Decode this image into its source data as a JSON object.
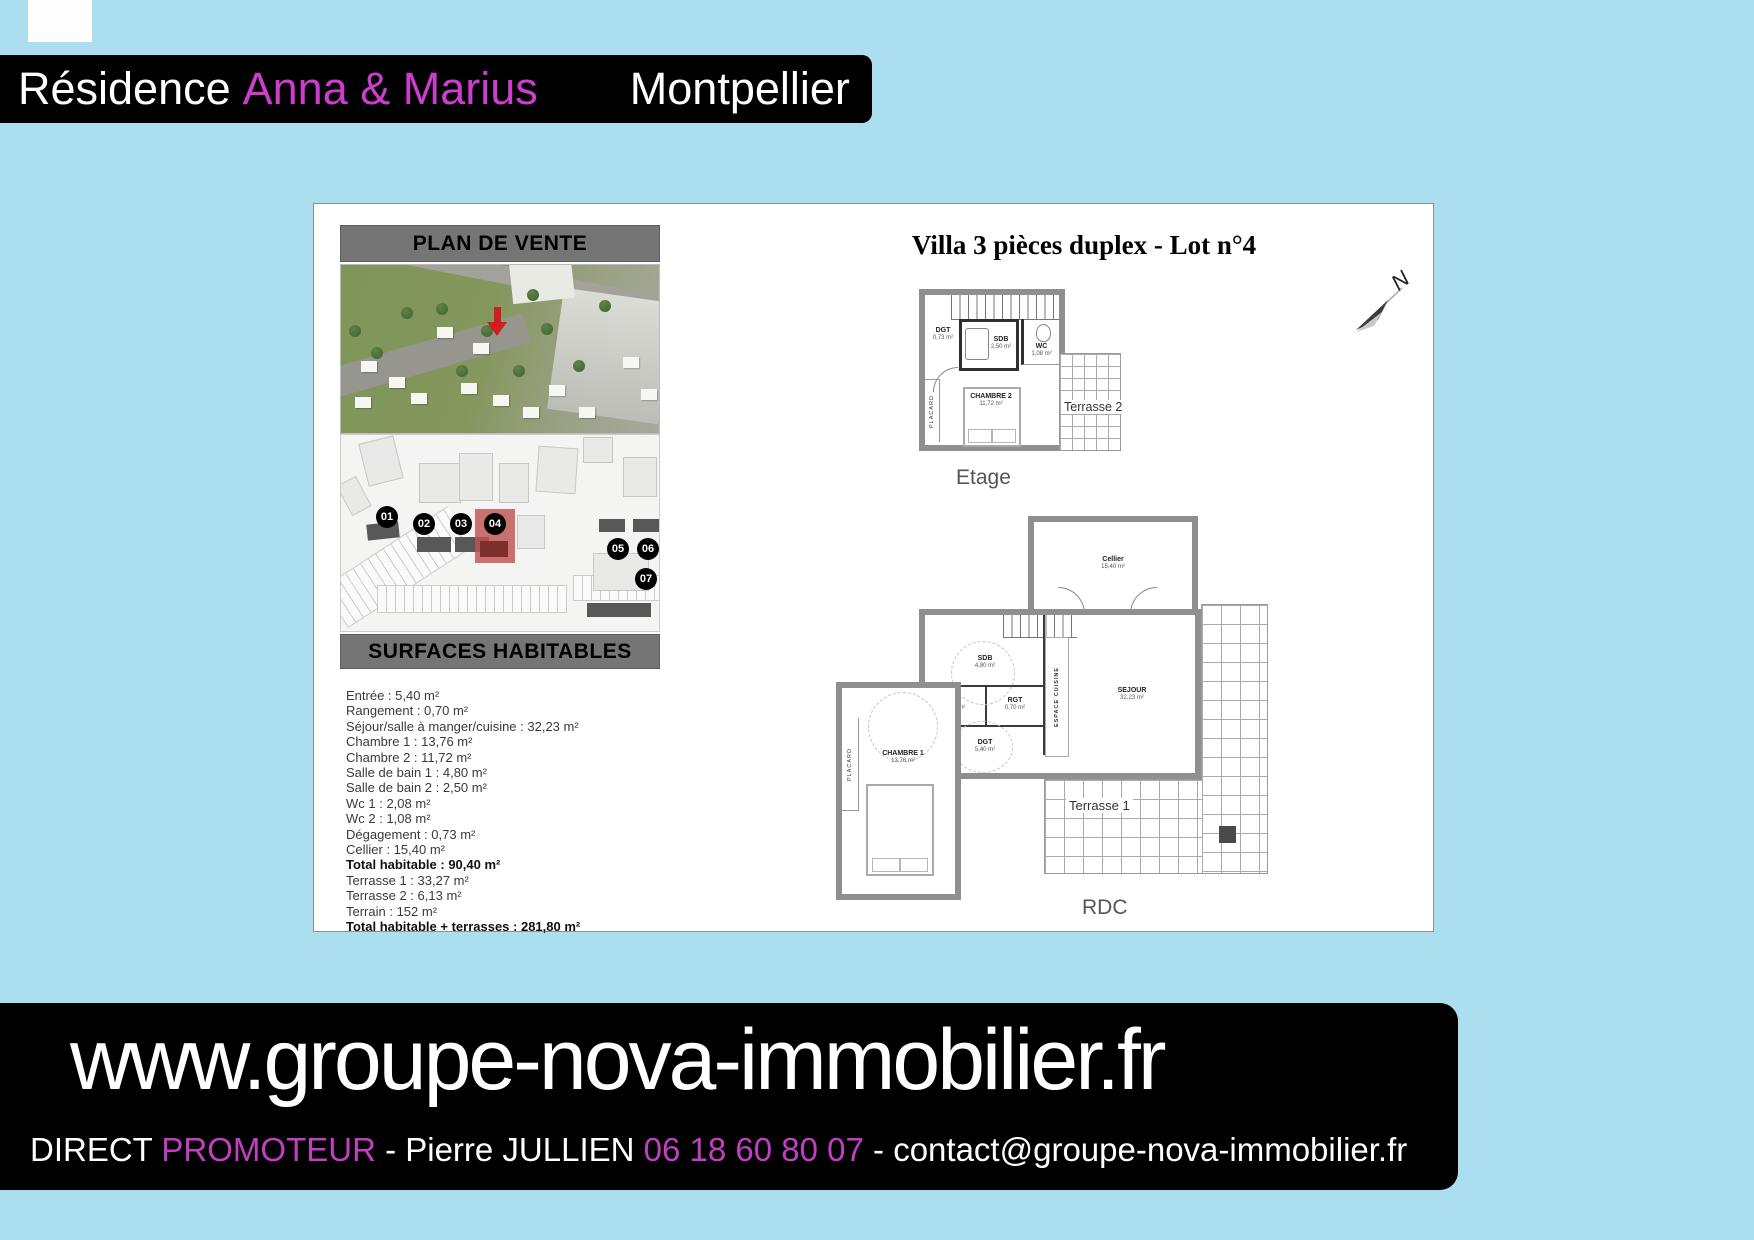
{
  "colors": {
    "background": "#ABDFF0",
    "accent_magenta": "#CC3FCC",
    "footer_magenta": "#C13FC1",
    "bar_gray": "#757575",
    "highlight_lot_red": "#BE5450"
  },
  "header": {
    "residence": "Résidence",
    "name": "Anna & Marius",
    "city": "Montpellier"
  },
  "plan_de_vente": {
    "title": "PLAN DE VENTE"
  },
  "site_plan": {
    "lots": [
      "01",
      "02",
      "03",
      "04",
      "05",
      "06",
      "07"
    ],
    "highlighted_lot": "04"
  },
  "surfaces": {
    "title": "SURFACES HABITABLES",
    "items": [
      "Entrée : 5,40 m²",
      "Rangement : 0,70 m²",
      "Séjour/salle à manger/cuisine : 32,23 m²",
      "Chambre 1 : 13,76 m²",
      "Chambre 2 : 11,72 m²",
      "Salle de bain 1 : 4,80 m²",
      "Salle de bain 2 : 2,50 m²",
      "Wc 1 : 2,08 m²",
      "Wc 2 : 1,08 m²",
      "Dégagement : 0,73 m²",
      "Cellier : 15,40 m²",
      "Total habitable : 90,40 m²",
      "Terrasse 1 : 33,27 m²",
      "Terrasse 2 : 6,13 m²",
      "Terrain : 152 m²",
      "Total habitable + terrasses : 281,80 m²"
    ]
  },
  "villa": {
    "title": "Villa 3 pièces duplex - Lot n°4",
    "north": "N",
    "etage": {
      "caption": "Etage",
      "dgt": "DGT",
      "dgt_area": "0,73 m²",
      "sdb": "SDB",
      "sdb_area": "2,50 m²",
      "wc": "WC",
      "wc_area": "1,08 m²",
      "chambre": "CHAMBRE 2",
      "chambre_area": "11,72 m²",
      "placard": "PLACARD",
      "terrasse": "Terrasse 2"
    },
    "rdc": {
      "caption": "RDC",
      "cellier": "Cellier",
      "cellier_area": "15,40 m²",
      "sdb": "SDB",
      "sdb_area": "4,80 m²",
      "wc": "WC",
      "wc_area": "2,08 m²",
      "rgt": "RGT",
      "rgt_area": "0,70 m²",
      "dgt": "DGT",
      "dgt_area": "5,40 m²",
      "cuisine": "ESPACE CUISINE",
      "sejour": "SEJOUR",
      "sejour_area": "32,23 m²",
      "chambre": "CHAMBRE 1",
      "chambre_area": "13,76 m²",
      "placard": "PLACARD",
      "terrasse": "Terrasse 1"
    }
  },
  "footer": {
    "url": "www.groupe-nova-immobilier.fr",
    "direct": "DIRECT ",
    "promoteur": "PROMOTEUR",
    "sep1": " - ",
    "contact_name": "Pierre JULLIEN ",
    "phone": "06 18 60 80 07",
    "sep2": " - ",
    "email": "contact@groupe-nova-immobilier.fr"
  }
}
